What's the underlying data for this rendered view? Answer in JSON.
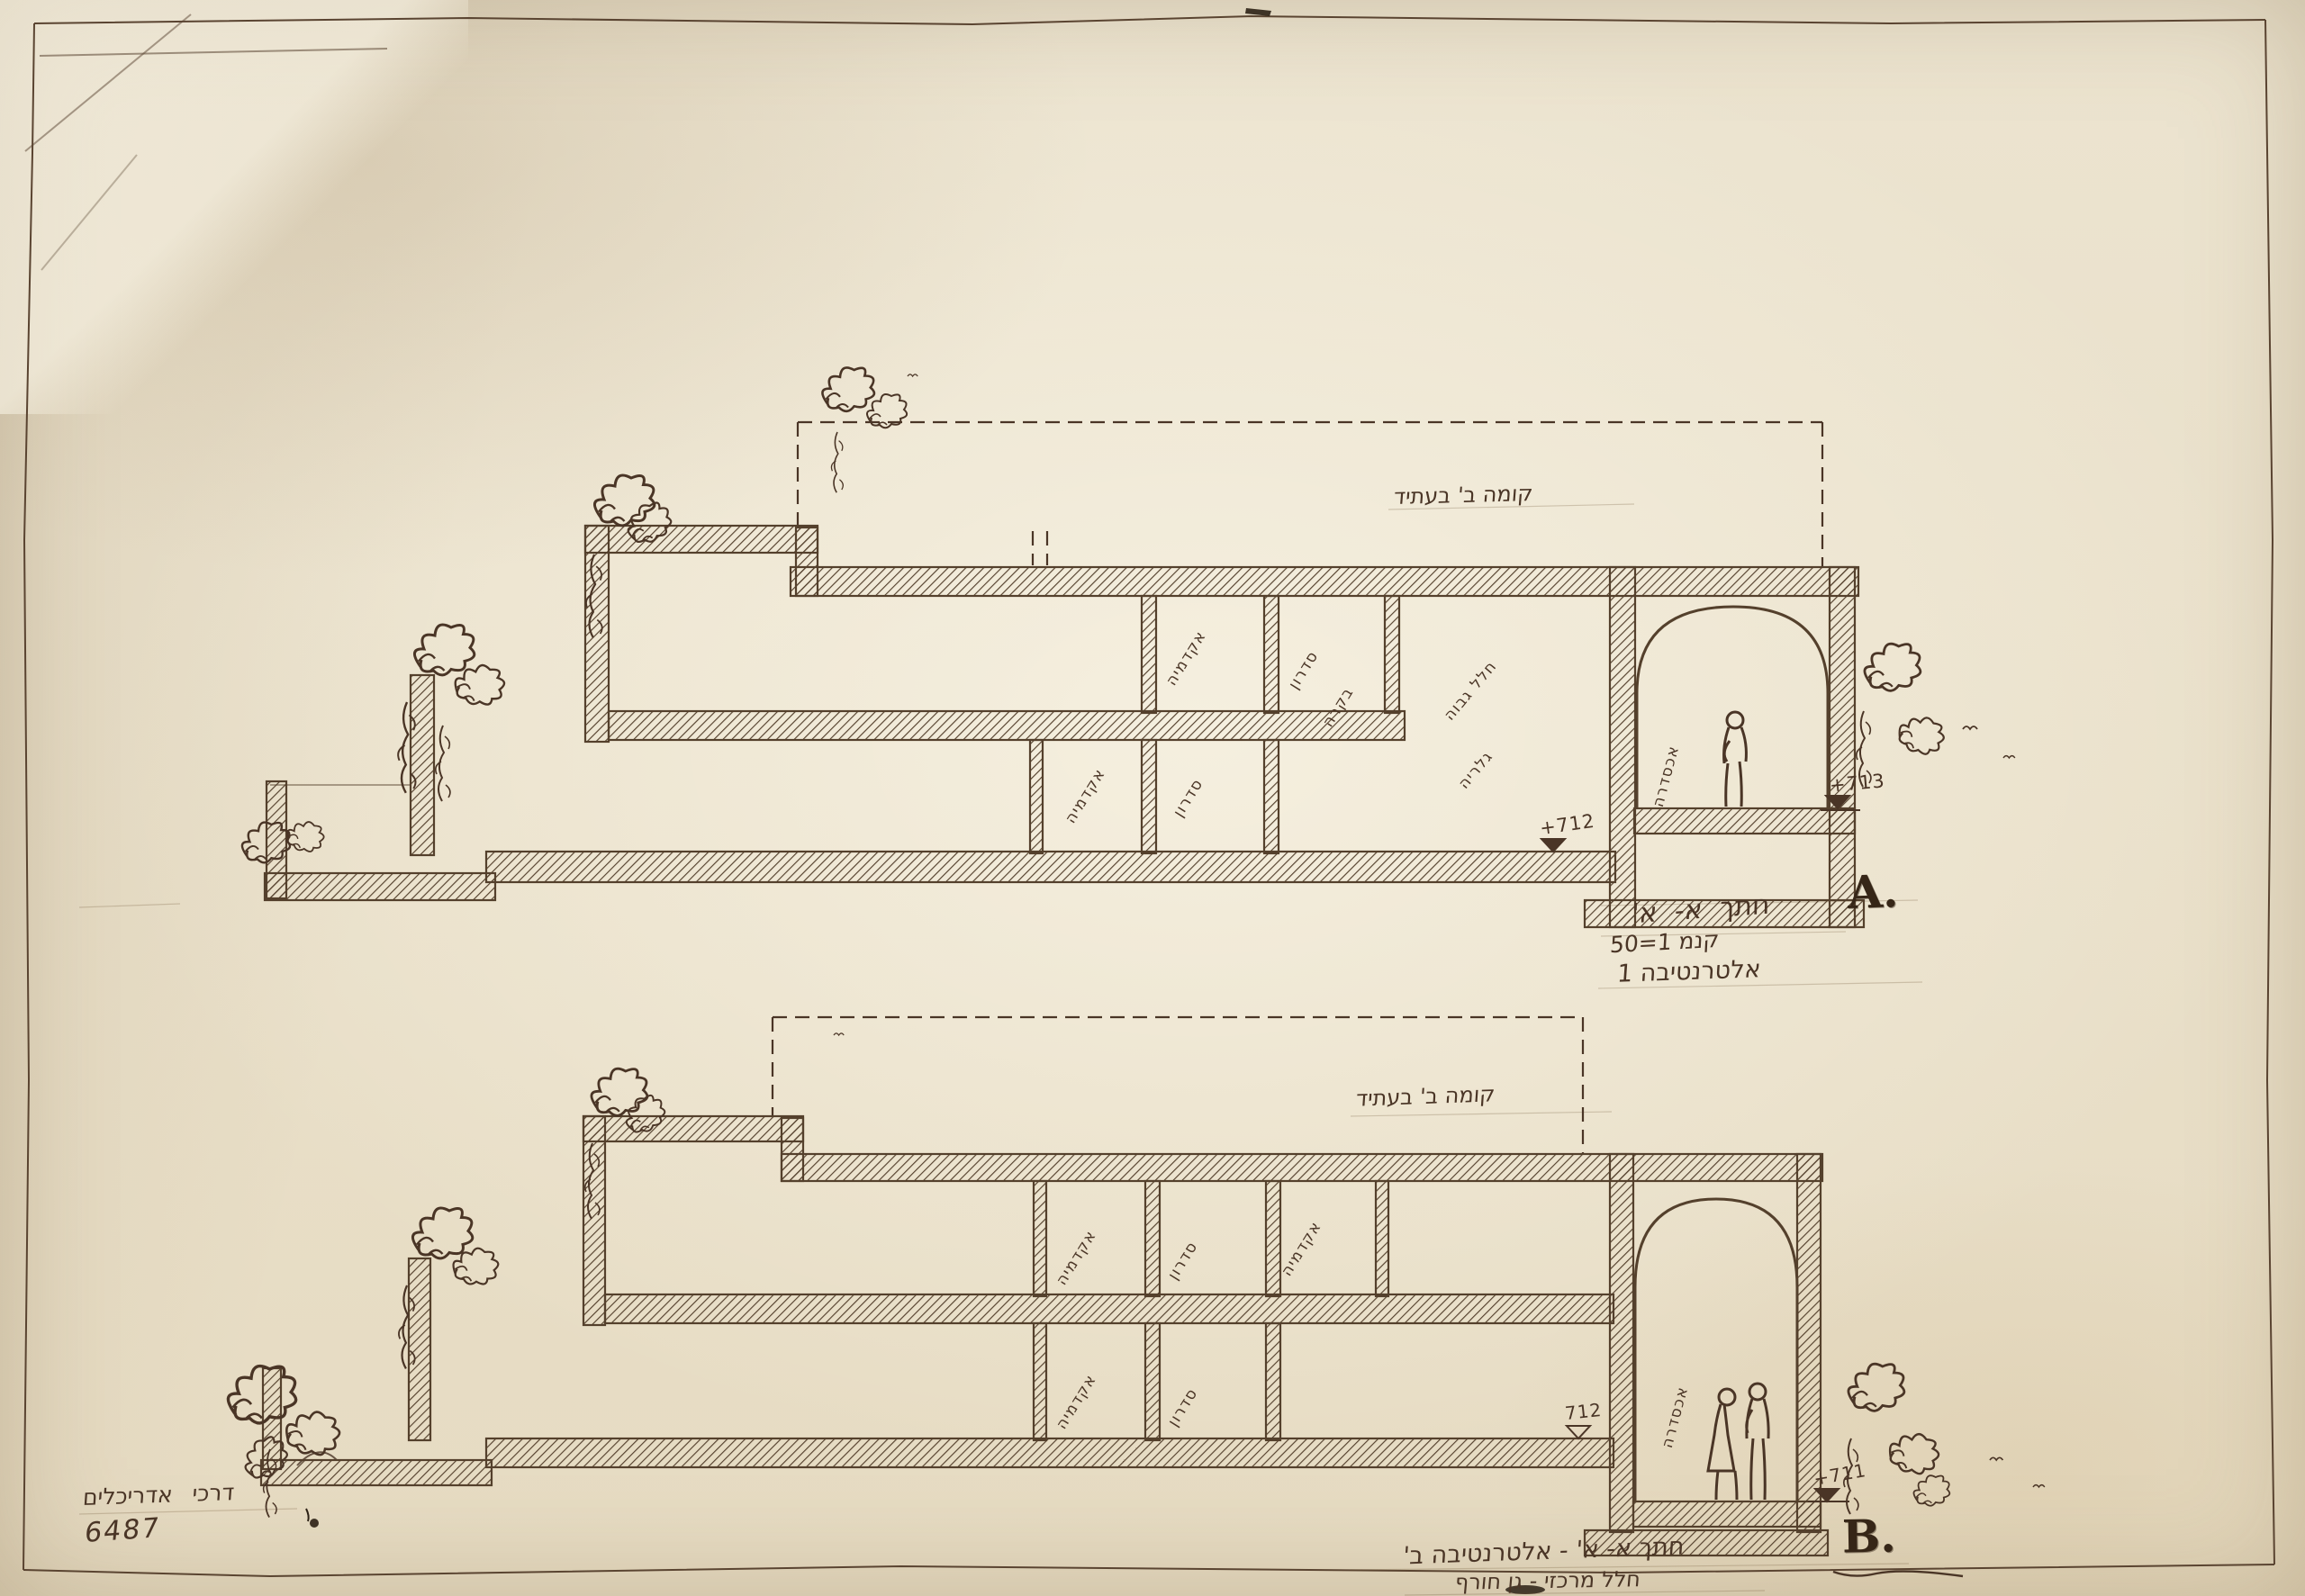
{
  "colors": {
    "paper": "#ece4d0",
    "ink": "#4a3526",
    "stamp": "#362617"
  },
  "section_a": {
    "marker": "A.",
    "title": "חתך א- א'",
    "scale": "קנמ 1=50",
    "alternative": "אלטרנטיבה 1",
    "future_floor_label": "קומה ב' בעתיד",
    "level_mid": "+712",
    "level_right": "+713",
    "rooms": [
      {
        "label": "אקדמיה"
      },
      {
        "label": "סדרון"
      },
      {
        "label": "בקרה"
      },
      {
        "label": "אקדמיה"
      },
      {
        "label": "סדרון"
      }
    ],
    "hall_label_line1": "חלל גבוה",
    "hall_label_line2": "גלריה",
    "portico_label": "אכסדרה"
  },
  "section_b": {
    "marker": "B.",
    "title": "חתך א- א' - אלטרנטיבה ב'",
    "subtitle": "חלל מרכזי - גן חורף",
    "future_floor_label": "קומה ב' בעתיד",
    "level_mid": "712",
    "level_right": "+711",
    "rooms": [
      {
        "label": "אקדמיה"
      },
      {
        "label": "סדרון"
      },
      {
        "label": "אקדמיה"
      },
      {
        "label": "אקדמיה"
      },
      {
        "label": "סדרון"
      }
    ],
    "portico_label": "אכסדרה"
  },
  "footer": {
    "firm": "דרכי אדריכלים",
    "number": "6487"
  }
}
